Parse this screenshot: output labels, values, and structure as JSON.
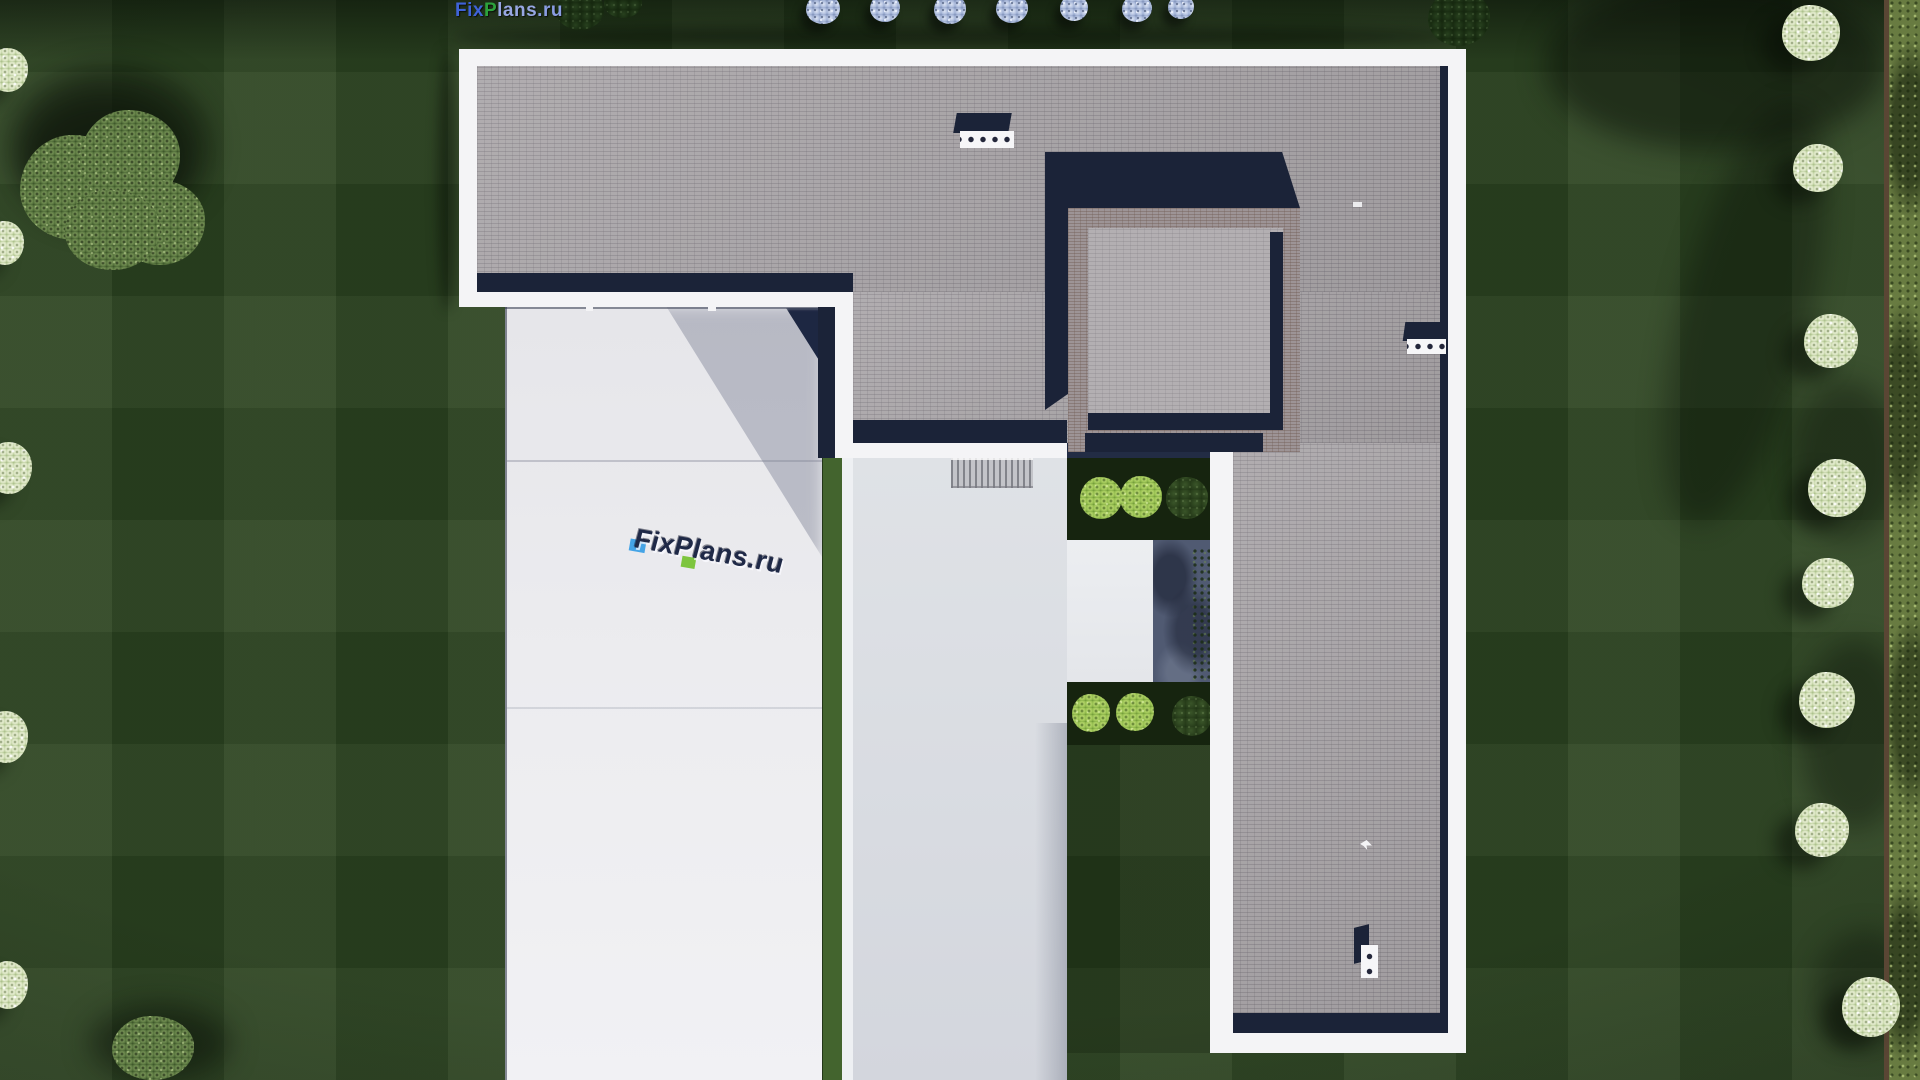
{
  "logo": {
    "segments": [
      {
        "text": "Fix",
        "color": "#3f63d8"
      },
      {
        "text": "P",
        "color": "#2da23c"
      },
      {
        "text": "lans",
        "color": "#97a7e2"
      },
      {
        "text": ".ru",
        "color": "#8a9de2"
      }
    ]
  },
  "center_watermark": {
    "text": "FixPlans.ru",
    "text_color": "#1f2947",
    "accent_blue": "#45a4e6",
    "accent_green": "#7dc53e"
  },
  "palette": {
    "lawn_green": "#2a4120",
    "roof_tile_gray": "#a8a4a7",
    "parapet_white": "#f4f4f6",
    "shadow_navy": "#1b2338",
    "driveway_light": "#e8e8ec",
    "courtyard_ring": "#9d9496",
    "water_feature": "#505a72",
    "bush_bright_green": "#9cc455",
    "frosted_tree": "#dde8c4",
    "hedge_green": "#687b41"
  }
}
